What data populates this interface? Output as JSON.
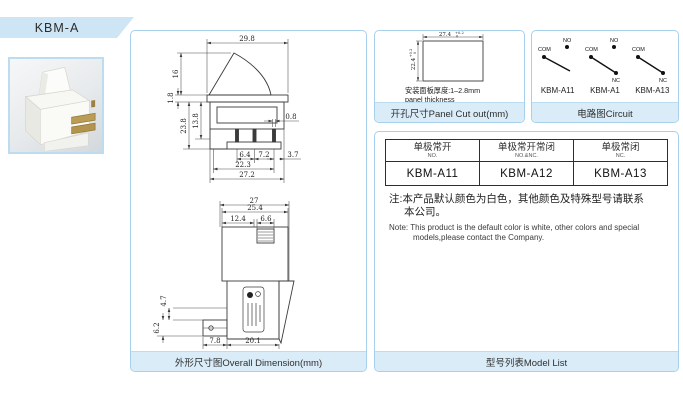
{
  "banner": {
    "model": "KBM-A"
  },
  "colors": {
    "banner_bg": "#cde5f5",
    "panel_border": "#a6d0ec",
    "caption_bg": "#d9ecf8",
    "drawing_line": "#3b3b3b",
    "terminal_brass": "#bb9c55"
  },
  "panels": {
    "overall_dimension": {
      "caption": "外形尺寸图Overall Dimension(mm)",
      "front_dims": {
        "top_width": "29.8",
        "actuator_height": "16",
        "collar": "1.8",
        "window_height": "13.8",
        "body_height": "23.8",
        "pin_width": "0.8",
        "pin_pitch_left": "6.4",
        "pin_pitch_right": "7.2",
        "pin_edge": "3.7",
        "pin_span": "22.3",
        "body_width": "27.2"
      },
      "side_dims": {
        "overall_width": "27",
        "body_width": "25.4",
        "left_section": "12.4",
        "slot_width": "6.6",
        "arm_height": "4.7",
        "arm_thickness": "6.2",
        "arm_length": "7.8",
        "body_depth": "20.1"
      }
    },
    "panel_cutout": {
      "caption": "开孔尺寸Panel  Cut out(mm)",
      "cut_width": "27.4",
      "cut_height": "22.4",
      "tol_upper": "+0.2",
      "tol_lower": "0",
      "note_cn": "安装面板厚度:1–2.8mm",
      "note_en": "panel thickness"
    },
    "circuit": {
      "caption": "电路图Circuit",
      "items": [
        {
          "label": "KBM-A11",
          "terminals": {
            "com": "COM",
            "no": "NO"
          }
        },
        {
          "label": "KBM-A1",
          "terminals": {
            "com": "COM",
            "no": "NO",
            "nc": "NC"
          }
        },
        {
          "label": "KBM-A13",
          "terminals": {
            "com": "COM",
            "nc": "NC"
          }
        }
      ]
    },
    "model_list": {
      "caption": "型号列表Model List",
      "table": {
        "headers": [
          {
            "cn": "单极常开",
            "en": "NO."
          },
          {
            "cn": "单极常开常闭",
            "en": "NO.&NC."
          },
          {
            "cn": "单极常闭",
            "en": "NC."
          }
        ],
        "row": [
          "KBM-A11",
          "KBM-A12",
          "KBM-A13"
        ]
      },
      "note_cn": [
        "注:本产品默认颜色为白色，其他颜色及特殊型号请联系",
        "本公司。"
      ],
      "note_en": [
        "Note: This product is the default color is white, other colors and special",
        "models,please contact the Company."
      ]
    }
  }
}
